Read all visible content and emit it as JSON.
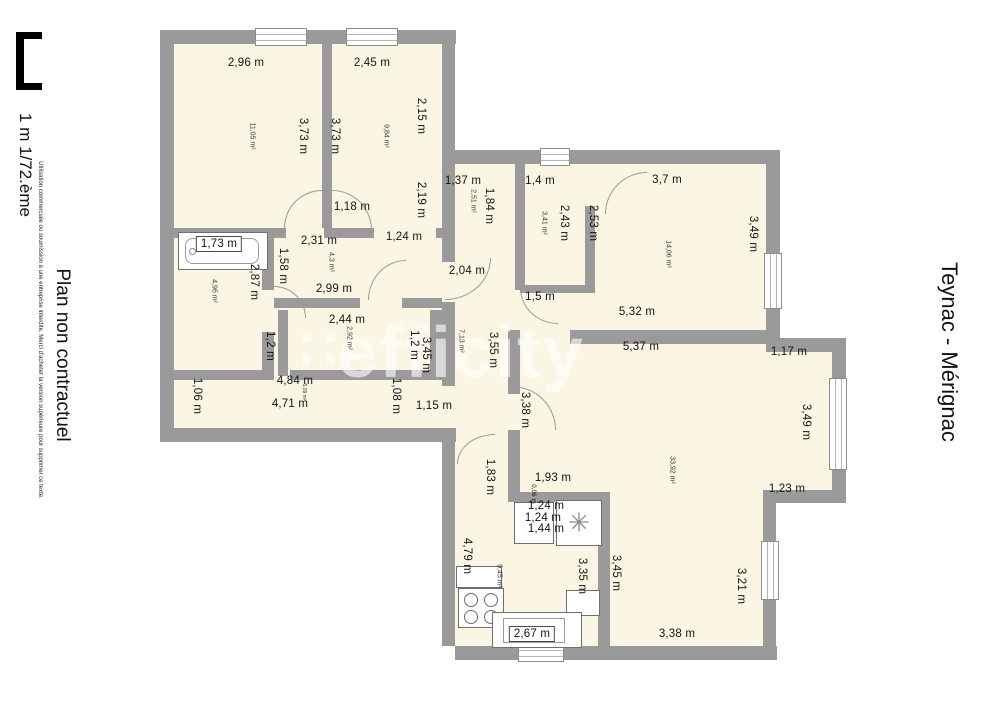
{
  "title": {
    "text": "Teynac - Mérignac"
  },
  "sidebar": {
    "scale_label": "1 m 1/72.ème",
    "fine_print": "Utilisation commerciale ou soumission à une entreprise interdite. Merci d'acheter la version supérieure pour supprimer ce texte.",
    "disclaimer": "Plan non contractuel"
  },
  "watermark": {
    "logo": "∷",
    "text": "efficity"
  },
  "colors": {
    "wall": "#9a9a9a",
    "floor": "#fbf5e4",
    "background": "#ffffff",
    "text": "#141414"
  },
  "plan": {
    "dimension_labels": [
      {
        "t": "2,96 m",
        "x": 246,
        "y": 63
      },
      {
        "t": "2,45 m",
        "x": 372,
        "y": 63
      },
      {
        "t": "3,73 m",
        "x": 303,
        "y": 136,
        "r": 90
      },
      {
        "t": "3,73 m",
        "x": 335,
        "y": 136,
        "r": 90
      },
      {
        "t": "2,15 m",
        "x": 421,
        "y": 116,
        "r": 90
      },
      {
        "t": "2,19 m",
        "x": 421,
        "y": 200,
        "r": 90
      },
      {
        "t": "1,18 m",
        "x": 352,
        "y": 207
      },
      {
        "t": "1,24 m",
        "x": 404,
        "y": 237
      },
      {
        "t": "1,37 m",
        "x": 463,
        "y": 181
      },
      {
        "t": "1,84 m",
        "x": 489,
        "y": 206,
        "r": 90
      },
      {
        "t": "1,4 m",
        "x": 540,
        "y": 181
      },
      {
        "t": "2,43 m",
        "x": 564,
        "y": 223,
        "r": 90
      },
      {
        "t": "2,53 m",
        "x": 593,
        "y": 223,
        "r": 90
      },
      {
        "t": "3,7 m",
        "x": 667,
        "y": 180
      },
      {
        "t": "3,49 m",
        "x": 753,
        "y": 234,
        "r": 90
      },
      {
        "t": "1,73 m",
        "x": 219,
        "y": 244,
        "b": true
      },
      {
        "t": "2,31 m",
        "x": 319,
        "y": 241
      },
      {
        "t": "1,58 m",
        "x": 283,
        "y": 266,
        "r": 90
      },
      {
        "t": "2,87 m",
        "x": 254,
        "y": 282,
        "r": 90
      },
      {
        "t": "2,99 m",
        "x": 334,
        "y": 289
      },
      {
        "t": "2,04 m",
        "x": 467,
        "y": 271
      },
      {
        "t": "1,5 m",
        "x": 540,
        "y": 297
      },
      {
        "t": "5,32 m",
        "x": 637,
        "y": 312
      },
      {
        "t": "5,37 m",
        "x": 641,
        "y": 347
      },
      {
        "t": "1,17 m",
        "x": 789,
        "y": 352
      },
      {
        "t": "2,44 m",
        "x": 347,
        "y": 320
      },
      {
        "t": "1,2 m",
        "x": 270,
        "y": 346,
        "r": 90
      },
      {
        "t": "1,2 m",
        "x": 414,
        "y": 345,
        "r": 90
      },
      {
        "t": "3,45 m",
        "x": 426,
        "y": 355,
        "r": 90
      },
      {
        "t": "3,55 m",
        "x": 493,
        "y": 350,
        "r": 90
      },
      {
        "t": "3,49 m",
        "x": 806,
        "y": 422,
        "r": 90
      },
      {
        "t": "4,84 m",
        "x": 295,
        "y": 381
      },
      {
        "t": "4,71 m",
        "x": 290,
        "y": 404
      },
      {
        "t": "1,06 m",
        "x": 197,
        "y": 396,
        "r": 90
      },
      {
        "t": "1,08 m",
        "x": 396,
        "y": 396,
        "r": 90
      },
      {
        "t": "1,15 m",
        "x": 434,
        "y": 406
      },
      {
        "t": "3,38 m",
        "x": 525,
        "y": 410,
        "r": 90
      },
      {
        "t": "1,83 m",
        "x": 490,
        "y": 477,
        "r": 90
      },
      {
        "t": "1,93 m",
        "x": 553,
        "y": 478
      },
      {
        "t": "1,23 m",
        "x": 787,
        "y": 489
      },
      {
        "t": "0,06 m",
        "x": 533,
        "y": 494,
        "r": 90,
        "s": 6
      },
      {
        "t": "1,24 m",
        "x": 546,
        "y": 506
      },
      {
        "t": "1,24 m",
        "x": 543,
        "y": 518
      },
      {
        "t": "1,44 m",
        "x": 546,
        "y": 529
      },
      {
        "t": "4,79 m",
        "x": 467,
        "y": 556,
        "r": 90
      },
      {
        "t": "3,35 m",
        "x": 582,
        "y": 576,
        "r": 90
      },
      {
        "t": "3,45 m",
        "x": 616,
        "y": 573,
        "r": 90
      },
      {
        "t": "3,21 m",
        "x": 741,
        "y": 586,
        "r": 90
      },
      {
        "t": "3,38 m",
        "x": 677,
        "y": 634
      },
      {
        "t": "2,67 m",
        "x": 532,
        "y": 634,
        "b": true
      }
    ],
    "area_labels": [
      {
        "t": "11,05 m²",
        "x": 252,
        "y": 136
      },
      {
        "t": "9,84 m²",
        "x": 386,
        "y": 136
      },
      {
        "t": "2,51 m²",
        "x": 473,
        "y": 201
      },
      {
        "t": "3,41 m²",
        "x": 544,
        "y": 223
      },
      {
        "t": "14,06 m²",
        "x": 668,
        "y": 254
      },
      {
        "t": "4,96 m²",
        "x": 214,
        "y": 291
      },
      {
        "t": "4,3 m²",
        "x": 331,
        "y": 262
      },
      {
        "t": "2,92 m²",
        "x": 349,
        "y": 338
      },
      {
        "t": "7,13 m²",
        "x": 461,
        "y": 341
      },
      {
        "t": "5,09 m²",
        "x": 304,
        "y": 392,
        "s": 5
      },
      {
        "t": "33,92 m²",
        "x": 672,
        "y": 470
      },
      {
        "t": "9,45 m²",
        "x": 499,
        "y": 576
      }
    ]
  }
}
